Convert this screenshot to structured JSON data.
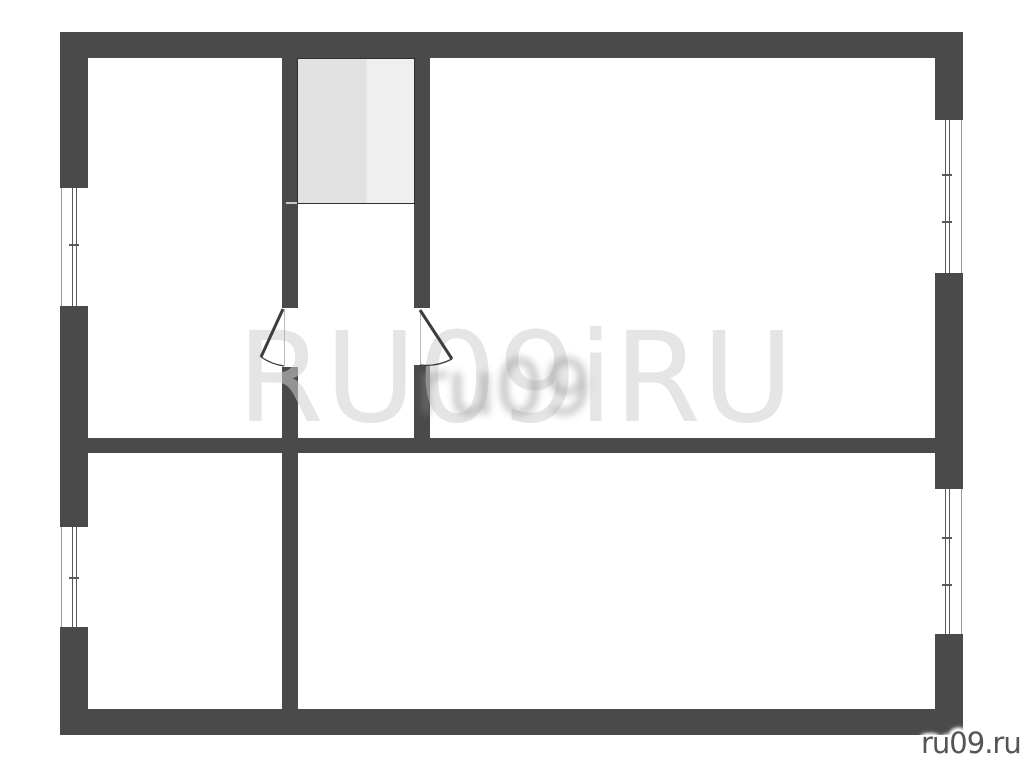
{
  "watermark": {
    "large_text": "RU09iRU",
    "center_text": "ru09",
    "site_label": "ru09.ru"
  },
  "colors": {
    "background": "#ffffff",
    "wall": "#4a4a4a",
    "window-frame": "#5a5a5a",
    "window-edge": "#9a9a9a",
    "closet-border": "#2f2f2f",
    "closet-fill-left": "#e2e2e2",
    "closet-fill-right": "#efefef",
    "watermark-light": "#d0d0d0",
    "watermark-center": "#8a8a8a",
    "site-label": "#555555"
  },
  "plan": {
    "walls": [
      {
        "name": "outer-wall-top",
        "x": 60,
        "y": 32,
        "w": 903,
        "h": 26
      },
      {
        "name": "outer-wall-bottom",
        "x": 60,
        "y": 709,
        "w": 903,
        "h": 26
      },
      {
        "name": "outer-wall-left",
        "x": 60,
        "y": 32,
        "w": 28,
        "h": 703
      },
      {
        "name": "outer-wall-right",
        "x": 935,
        "y": 32,
        "w": 28,
        "h": 703
      },
      {
        "name": "interior-wall-horizontal",
        "x": 88,
        "y": 438,
        "w": 847,
        "h": 15
      },
      {
        "name": "interior-wall-left-upper",
        "x": 282,
        "y": 58,
        "w": 16,
        "h": 250
      },
      {
        "name": "interior-wall-left-lower",
        "x": 282,
        "y": 367,
        "w": 16,
        "h": 342
      },
      {
        "name": "interior-wall-right-upper",
        "x": 414,
        "y": 58,
        "w": 16,
        "h": 250
      },
      {
        "name": "interior-wall-right-lower",
        "x": 414,
        "y": 365,
        "w": 16,
        "h": 73
      }
    ],
    "windows": [
      {
        "name": "window-left-upper",
        "side": "left",
        "x": 60,
        "y": 188,
        "w": 28,
        "h": 118,
        "ticks": [
          56
        ]
      },
      {
        "name": "window-left-lower",
        "side": "left",
        "x": 60,
        "y": 527,
        "w": 28,
        "h": 100,
        "ticks": [
          50
        ]
      },
      {
        "name": "window-right-upper",
        "side": "right",
        "x": 935,
        "y": 120,
        "w": 28,
        "h": 153,
        "ticks": [
          54,
          101
        ]
      },
      {
        "name": "window-right-lower",
        "side": "right",
        "x": 935,
        "y": 489,
        "w": 28,
        "h": 145,
        "ticks": [
          48,
          95
        ]
      }
    ],
    "closet": {
      "name": "closet",
      "x": 297,
      "y": 58,
      "w": 118,
      "h": 146,
      "tick": {
        "x": 286,
        "y": 202,
        "w": 11,
        "h": 2
      }
    },
    "doors": [
      {
        "name": "door-left",
        "threshold": "M 284.5 309 L 284.5 366",
        "leaf": "M 283 309 L 261 357",
        "arc": "M 261 357 A 55 55 0 0 0 284 366"
      },
      {
        "name": "door-right",
        "threshold": "M 420.5 310 L 420.5 365",
        "leaf": "M 420 310 L 452 359",
        "arc": "M 452 359 A 55 55 0 0 1 420 365"
      }
    ],
    "rooms": [
      {
        "name": "room-top-left",
        "x": 88,
        "y": 58,
        "w": 194,
        "h": 380
      },
      {
        "name": "room-top-right",
        "x": 430,
        "y": 58,
        "w": 505,
        "h": 380
      },
      {
        "name": "hallway-center",
        "x": 298,
        "y": 204,
        "w": 116,
        "h": 234
      },
      {
        "name": "room-bottom-left",
        "x": 88,
        "y": 453,
        "w": 194,
        "h": 256
      },
      {
        "name": "room-bottom-right",
        "x": 298,
        "y": 453,
        "w": 637,
        "h": 256
      }
    ]
  }
}
